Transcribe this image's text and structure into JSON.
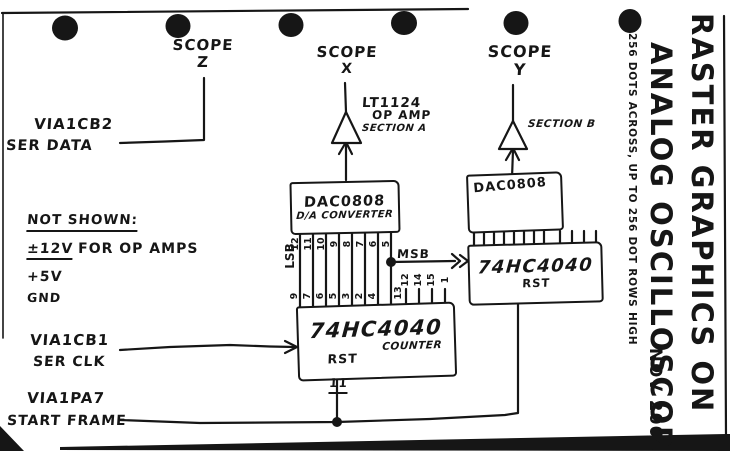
{
  "colors": {
    "ink": "#161616",
    "paper": "#ffffff"
  },
  "title_block": {
    "line1": "RASTER GRAPHICS ON",
    "line2": "ANALOG OSCILLOSCOPE",
    "detail_note": "256 DOTS ACROSS, UP TO 256 DOT ROWS HIGH",
    "date": "NOV 2004"
  },
  "scopes": {
    "z": {
      "label": "SCOPE",
      "channel": "Z"
    },
    "x": {
      "label": "SCOPE",
      "channel": "X"
    },
    "y": {
      "label": "SCOPE",
      "channel": "Y"
    }
  },
  "opamp_x": {
    "part": "LT1124",
    "kind": "OP AMP",
    "section": "SECTION A"
  },
  "opamp_y": {
    "section": "SECTION B"
  },
  "dac_x": {
    "name": "DAC0808",
    "kind": "D/A CONVERTER"
  },
  "dac_y": {
    "name": "DAC0808"
  },
  "counter_x": {
    "name": "74HC4040",
    "kind": "COUNTER",
    "reset_label": "RST",
    "reset_pin": "11"
  },
  "counter_y": {
    "name": "74HC4040",
    "reset_label": "RST"
  },
  "bus": {
    "lsb": "LSB",
    "msb": "MSB",
    "dac_input_pins": [
      "12",
      "11",
      "10",
      "9",
      "8",
      "7",
      "6",
      "5"
    ],
    "counter_output_pins": [
      "9",
      "7",
      "6",
      "5",
      "3",
      "2",
      "4",
      "13"
    ],
    "counter_upper_pins": [
      "12",
      "14",
      "15",
      "1"
    ]
  },
  "io": {
    "data": {
      "port": "VIA1CB2",
      "desc": "SER DATA"
    },
    "clock": {
      "port": "VIA1CB1",
      "desc": "SER CLK"
    },
    "frame": {
      "port": "VIA1PA7",
      "desc": "START FRAME"
    }
  },
  "power_notes": {
    "heading": "NOT SHOWN:",
    "opamp_supply": "±12V",
    "opamp_supply_for": "FOR OP AMPS",
    "logic_supply": "+5V",
    "ground": "GND"
  }
}
